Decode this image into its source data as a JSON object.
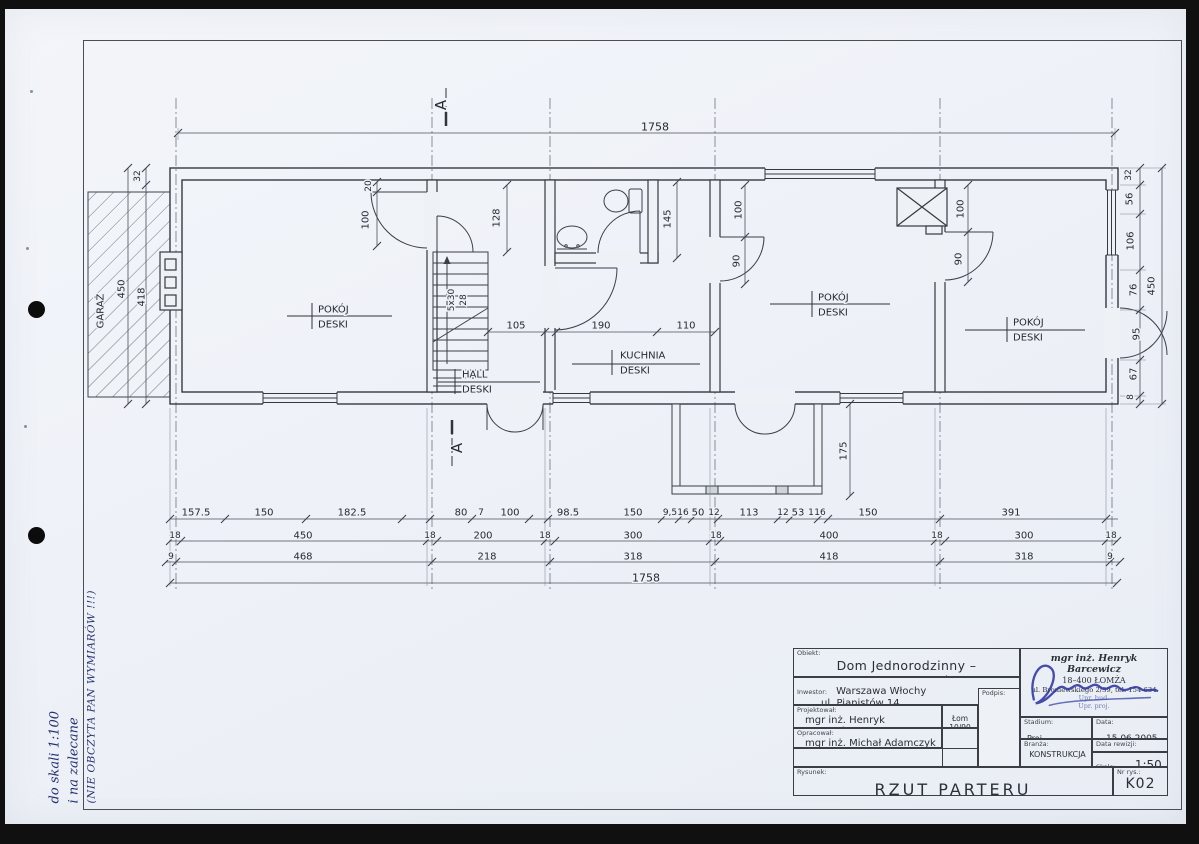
{
  "colors": {
    "ink": "#343a41",
    "signature_blue": "#2d36a3",
    "paper": "#eef1f6"
  },
  "scan": {
    "note_lines": [
      "do skali 1:100",
      "i na zalecane",
      "(NIE OBCZYTA PAN WYMIARÓW !!!)"
    ]
  },
  "plan": {
    "annotations": [
      {
        "t": "1758",
        "x": 655,
        "y": 127,
        "s": 11
      },
      {
        "t": "A",
        "x": 441,
        "y": 105,
        "r": -90,
        "s": 15
      },
      {
        "t": "A",
        "x": 457,
        "y": 448,
        "r": -90,
        "s": 15
      },
      {
        "t": "32",
        "x": 138,
        "y": 176,
        "r": -90,
        "s": 9
      },
      {
        "t": "450",
        "x": 122,
        "y": 289,
        "r": -90
      },
      {
        "t": "418",
        "x": 142,
        "y": 297,
        "r": -90
      },
      {
        "t": "GARAŻ",
        "x": 101,
        "y": 311,
        "r": -90
      },
      {
        "t": "20",
        "x": 369,
        "y": 186,
        "r": -90,
        "s": 9
      },
      {
        "t": "100",
        "x": 366,
        "y": 220,
        "r": -90
      },
      {
        "t": "128",
        "x": 497,
        "y": 218,
        "r": -90
      },
      {
        "t": "5x30",
        "x": 452,
        "y": 300,
        "r": -90,
        "s": 9
      },
      {
        "t": "28",
        "x": 464,
        "y": 300,
        "r": -90,
        "s": 9
      },
      {
        "t": "145",
        "x": 668,
        "y": 219,
        "r": -90
      },
      {
        "t": "100",
        "x": 739,
        "y": 210,
        "r": -90
      },
      {
        "t": "90",
        "x": 737,
        "y": 261,
        "r": -90
      },
      {
        "t": "100",
        "x": 961,
        "y": 209,
        "r": -90
      },
      {
        "t": "90",
        "x": 959,
        "y": 259,
        "r": -90
      },
      {
        "t": "105",
        "x": 516,
        "y": 326
      },
      {
        "t": "190",
        "x": 601,
        "y": 326
      },
      {
        "t": "110",
        "x": 686,
        "y": 326
      },
      {
        "t": "175",
        "x": 844,
        "y": 451,
        "r": -90
      },
      {
        "t": "POKÓJ",
        "x": 318,
        "y": 310,
        "a": "s"
      },
      {
        "t": "DESKI",
        "x": 318,
        "y": 325,
        "a": "s"
      },
      {
        "t": "HALL",
        "x": 462,
        "y": 375,
        "a": "s"
      },
      {
        "t": "DESKI",
        "x": 462,
        "y": 390,
        "a": "s"
      },
      {
        "t": "KUCHNIA",
        "x": 620,
        "y": 356,
        "a": "s"
      },
      {
        "t": "DESKI",
        "x": 620,
        "y": 371,
        "a": "s"
      },
      {
        "t": "POKÓJ",
        "x": 818,
        "y": 298,
        "a": "s"
      },
      {
        "t": "DESKI",
        "x": 818,
        "y": 313,
        "a": "s"
      },
      {
        "t": "POKÓJ",
        "x": 1013,
        "y": 323,
        "a": "s"
      },
      {
        "t": "DESKI",
        "x": 1013,
        "y": 338,
        "a": "s"
      },
      {
        "t": "157.5",
        "x": 196,
        "y": 513
      },
      {
        "t": "150",
        "x": 264,
        "y": 513
      },
      {
        "t": "182.5",
        "x": 352,
        "y": 513
      },
      {
        "t": "80",
        "x": 461,
        "y": 513
      },
      {
        "t": "7",
        "x": 481,
        "y": 513,
        "s": 9
      },
      {
        "t": "100",
        "x": 510,
        "y": 513
      },
      {
        "t": "98.5",
        "x": 568,
        "y": 513
      },
      {
        "t": "150",
        "x": 633,
        "y": 513
      },
      {
        "t": "9,5",
        "x": 670,
        "y": 513,
        "s": 9
      },
      {
        "t": "16",
        "x": 683,
        "y": 513,
        "s": 9
      },
      {
        "t": "50",
        "x": 698,
        "y": 513
      },
      {
        "t": "12",
        "x": 714,
        "y": 513,
        "s": 9
      },
      {
        "t": "113",
        "x": 749,
        "y": 513
      },
      {
        "t": "12",
        "x": 783,
        "y": 513,
        "s": 9
      },
      {
        "t": "53",
        "x": 798,
        "y": 513
      },
      {
        "t": "1",
        "x": 811,
        "y": 513,
        "s": 9
      },
      {
        "t": "16",
        "x": 820,
        "y": 513,
        "s": 9
      },
      {
        "t": "150",
        "x": 868,
        "y": 513
      },
      {
        "t": "391",
        "x": 1011,
        "y": 513
      },
      {
        "t": "18",
        "x": 175,
        "y": 536,
        "s": 9
      },
      {
        "t": "450",
        "x": 303,
        "y": 536
      },
      {
        "t": "18",
        "x": 430,
        "y": 536,
        "s": 9
      },
      {
        "t": "200",
        "x": 483,
        "y": 536
      },
      {
        "t": "18",
        "x": 545,
        "y": 536,
        "s": 9
      },
      {
        "t": "300",
        "x": 633,
        "y": 536
      },
      {
        "t": "18",
        "x": 716,
        "y": 536,
        "s": 9
      },
      {
        "t": "400",
        "x": 829,
        "y": 536
      },
      {
        "t": "18",
        "x": 937,
        "y": 536,
        "s": 9
      },
      {
        "t": "300",
        "x": 1024,
        "y": 536
      },
      {
        "t": "18",
        "x": 1111,
        "y": 536,
        "s": 9
      },
      {
        "t": "9",
        "x": 171,
        "y": 557,
        "s": 9
      },
      {
        "t": "468",
        "x": 303,
        "y": 557
      },
      {
        "t": "218",
        "x": 487,
        "y": 557
      },
      {
        "t": "318",
        "x": 633,
        "y": 557
      },
      {
        "t": "418",
        "x": 829,
        "y": 557
      },
      {
        "t": "318",
        "x": 1024,
        "y": 557
      },
      {
        "t": "9",
        "x": 1110,
        "y": 557,
        "s": 9
      },
      {
        "t": "1758",
        "x": 646,
        "y": 578,
        "s": 11
      },
      {
        "t": "32",
        "x": 1129,
        "y": 175,
        "r": -90,
        "s": 9
      },
      {
        "t": "56",
        "x": 1130,
        "y": 199,
        "r": -90
      },
      {
        "t": "106",
        "x": 1131,
        "y": 241,
        "r": -90
      },
      {
        "t": "76",
        "x": 1134,
        "y": 290,
        "r": -90
      },
      {
        "t": "450",
        "x": 1152,
        "y": 286,
        "r": -90
      },
      {
        "t": "95",
        "x": 1137,
        "y": 334,
        "r": -90
      },
      {
        "t": "67",
        "x": 1134,
        "y": 374,
        "r": -90
      },
      {
        "t": "8",
        "x": 1131,
        "y": 397,
        "r": -90,
        "s": 9
      }
    ]
  },
  "title_block": {
    "obiekt_label": "Obiekt:",
    "obiekt": "Dom Jednorodzinny – Inwentaryzacja",
    "inwestor_label": "Inwestor:",
    "inwestor_line1": "Warszawa Włochy",
    "inwestor_line2": "ul. Pianistów 14",
    "podpis_label": "Podpis:",
    "projektowal_label": "Projektował:",
    "projektowal": "mgr inż. Henryk Barcewicz",
    "projektowal_nr": "Łom 10/90",
    "opracowal_label": "Opracował:",
    "opracowal": "mgr inż. Michał Adamczyk",
    "rysunek_label": "Rysunek:",
    "rysunek": "RZUT PARTERU",
    "stadium_label": "Stadium:",
    "stadium": "Proj. BUDOWLANY",
    "data_label": "Data:",
    "data": "15.06.2005",
    "branza_label": "Branża:",
    "branza": "KONSTRUKCJA",
    "data_rewizji_label": "Data rewizji:",
    "skala_label": "Skala:",
    "skala": "1:50",
    "nr_rys_label": "Nr rys.:",
    "nr_rys": "K02",
    "stamp": {
      "lines": [
        "mgr inż. Henryk Barcewicz",
        "18–400 ŁOMŻA",
        "ul. Broniewskiego 2/39, tel. 154-634",
        "Upr. bud.",
        "Upr. proj."
      ]
    }
  }
}
